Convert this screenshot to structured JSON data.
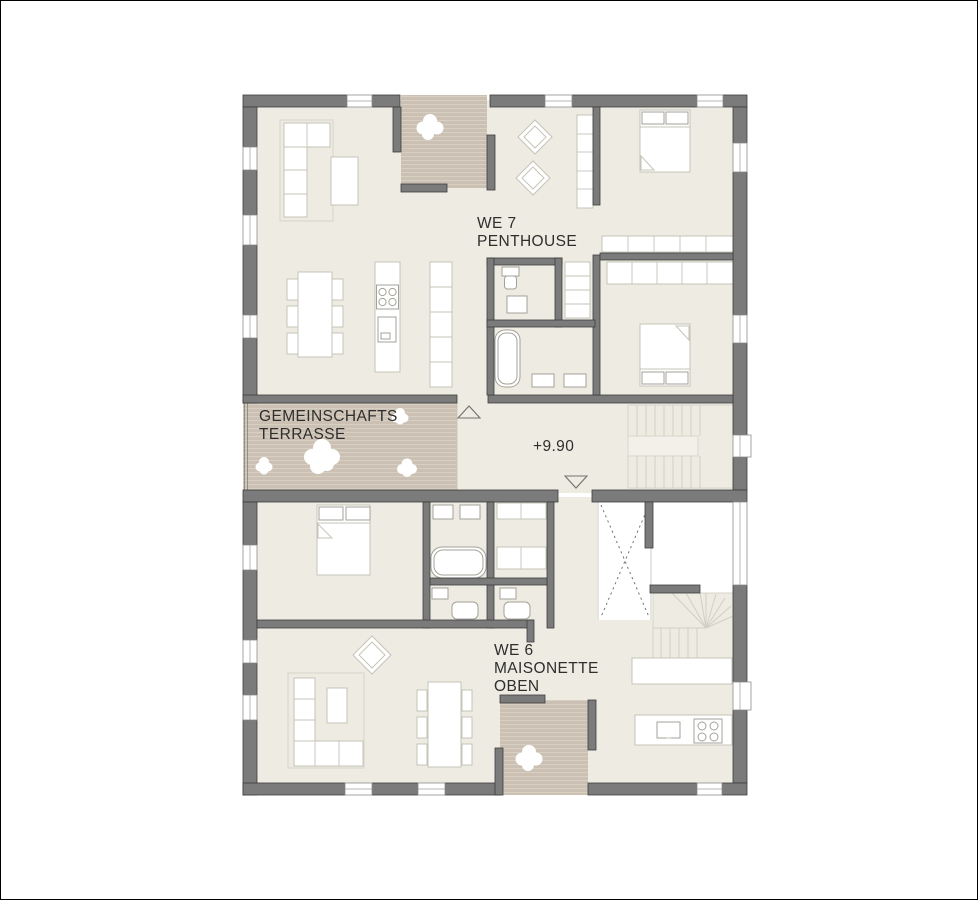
{
  "labels": {
    "we7": {
      "line1": "WE 7",
      "line2": "PENTHOUSE"
    },
    "terrace": {
      "line1": "GEMEINSCHAFTS",
      "line2": "TERRASSE"
    },
    "level": "+9.90",
    "we6": {
      "line1": "WE 6",
      "line2": "MAISONETTE",
      "line3": "OBEN"
    }
  },
  "colors": {
    "paper": "#ffffff",
    "wall": "#7b7b7b",
    "wall-edge": "#3e3e3e",
    "floor": "#edebe2",
    "deck": "#cbc0b3",
    "deck-line": "#d9d1c5",
    "line": "#c6c4b8",
    "fixture": "#a4a298",
    "stair-line": "#d2cfc3",
    "void-dash": "#75756f",
    "text": "#2e2e2c"
  }
}
